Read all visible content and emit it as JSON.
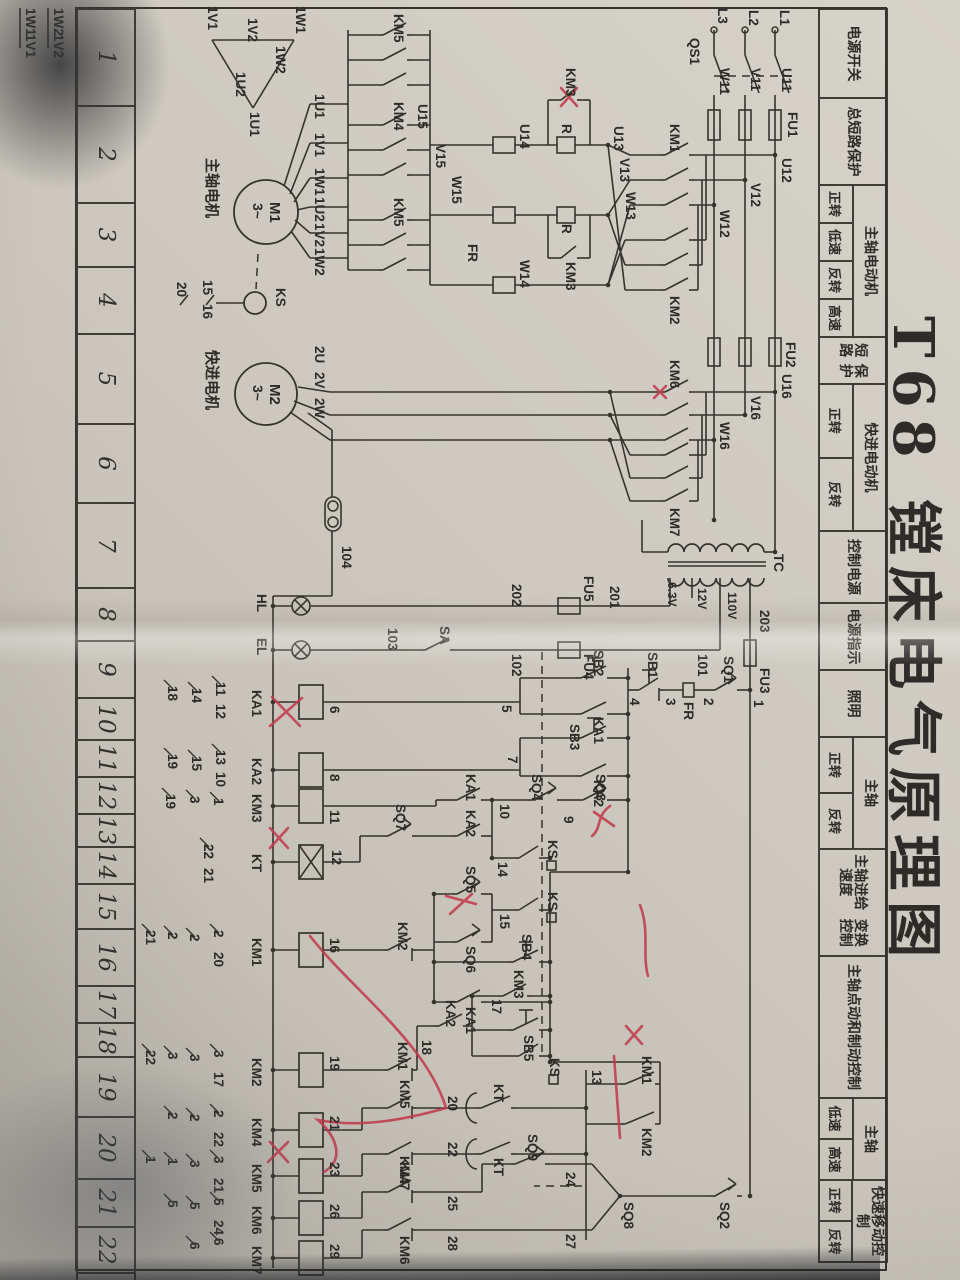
{
  "photo": {
    "paper": "#cdc9c0",
    "ink": "#36332d",
    "red": "#c23b4e"
  },
  "title": {
    "text": "T68 镗床电气原理图"
  },
  "function_table": {
    "cells": [
      {
        "lines": [
          "电源开关"
        ],
        "w": 87
      },
      {
        "lines": [
          "总短路保护"
        ],
        "w": 85
      },
      {
        "lines": [
          "主轴电动机"
        ],
        "w": 150,
        "sub": [
          "正转",
          "低速",
          "反转",
          "高速"
        ]
      },
      {
        "lines": [
          "短路",
          "保护"
        ],
        "w": 45
      },
      {
        "lines": [
          "快进电动机"
        ],
        "w": 145,
        "sub": [
          "正转",
          "反转"
        ]
      },
      {
        "lines": [
          "控制",
          "电源"
        ],
        "w": 70
      },
      {
        "lines": [
          "电源",
          "指示"
        ],
        "w": 65
      },
      {
        "lines": [
          "照明"
        ],
        "w": 65
      },
      {
        "lines": [
          "主轴"
        ],
        "w": 110,
        "sub": [
          "正转",
          "反转"
        ]
      },
      {
        "lines": [
          "主轴进给速度",
          "变换控制"
        ],
        "w": 105
      },
      {
        "lines": [
          "主轴点动",
          "和制动控制"
        ],
        "w": 140
      },
      {
        "lines": [
          "主轴"
        ],
        "w": 80,
        "sub": [
          "低速",
          "高速"
        ]
      },
      {
        "lines": [
          "快速移动控制"
        ],
        "w": 80,
        "sub": [
          "正转",
          "反转"
        ]
      }
    ]
  },
  "column_numbers": {
    "values": [
      "1",
      "2",
      "3",
      "4",
      "5",
      "6",
      "7",
      "8",
      "9",
      "10",
      "11",
      "12",
      "13",
      "14",
      "15",
      "16",
      "17",
      "18",
      "19",
      "20",
      "21",
      "22",
      "23"
    ],
    "widths": [
      95,
      95,
      62,
      65,
      88,
      77,
      83,
      51,
      55,
      40,
      35,
      35,
      31,
      35,
      43,
      55,
      35,
      32,
      58,
      60,
      46,
      44,
      42
    ]
  },
  "schematic": {
    "labels": [
      [
        "L1",
        10,
        180
      ],
      [
        "L2",
        10,
        211
      ],
      [
        "L3",
        8,
        242
      ],
      [
        "QS1",
        38,
        270
      ],
      [
        "U11",
        68,
        178
      ],
      [
        "V11",
        68,
        209
      ],
      [
        "W11",
        68,
        240
      ],
      [
        "FU1",
        112,
        172
      ],
      [
        "U12",
        158,
        178
      ],
      [
        "V12",
        183,
        209
      ],
      [
        "W12",
        210,
        240
      ],
      [
        "KM1",
        124,
        290
      ],
      [
        "KM2",
        296,
        290
      ],
      [
        "U13",
        126,
        346
      ],
      [
        "V13",
        158,
        340
      ],
      [
        "W13",
        192,
        334
      ],
      [
        "R",
        124,
        398
      ],
      [
        "R",
        224,
        398
      ],
      [
        "KM3",
        68,
        394
      ],
      [
        "KM3",
        262,
        394
      ],
      [
        "U14",
        124,
        440
      ],
      [
        "W14",
        260,
        440
      ],
      [
        "FR",
        244,
        492
      ],
      [
        "U15",
        104,
        542
      ],
      [
        "V15",
        144,
        524
      ],
      [
        "W15",
        176,
        508
      ],
      [
        "KM5",
        14,
        566
      ],
      [
        "KM4",
        102,
        566
      ],
      [
        "KM5",
        198,
        566
      ],
      [
        "1U1",
        94,
        645
      ],
      [
        "1V1",
        133,
        645
      ],
      [
        "1W1",
        168,
        645
      ],
      [
        "1U2",
        197,
        645
      ],
      [
        "1V2",
        223,
        645
      ],
      [
        "1W2",
        248,
        645
      ],
      [
        "主轴电机",
        158,
        753,
        15
      ],
      [
        "M1",
        202,
        690,
        15
      ],
      [
        "3~",
        203,
        707,
        14
      ],
      [
        "KS",
        288,
        684
      ],
      [
        "15",
        280,
        757
      ],
      [
        "16",
        304,
        757
      ],
      [
        "20",
        282,
        783
      ],
      [
        "1W1",
        6,
        664
      ],
      [
        "1W2",
        46,
        684
      ],
      [
        "1U1",
        112,
        710
      ],
      [
        "1U2",
        72,
        724
      ],
      [
        "1V2",
        18,
        712
      ],
      [
        "1V1",
        6,
        752
      ],
      [
        "1W2",
        8,
        906
      ],
      [
        "1V2",
        34,
        906
      ],
      [
        "1W1",
        8,
        934
      ],
      [
        "1V1",
        34,
        934
      ],
      [
        "FU2",
        342,
        174
      ],
      [
        "U16",
        374,
        178
      ],
      [
        "V16",
        396,
        209
      ],
      [
        "W16",
        422,
        240
      ],
      [
        "KM6",
        360,
        290
      ],
      [
        "KM7",
        508,
        290
      ],
      [
        "2U",
        346,
        645
      ],
      [
        "2V",
        372,
        645
      ],
      [
        "2W",
        398,
        645
      ],
      [
        "M2",
        384,
        690,
        15
      ],
      [
        "3~",
        385,
        707,
        14
      ],
      [
        "快进电机",
        350,
        753,
        15
      ],
      [
        "104",
        546,
        618
      ],
      [
        "TC",
        554,
        186
      ],
      [
        "110V",
        592,
        232,
        12
      ],
      [
        "12V",
        588,
        262,
        12
      ],
      [
        "6.3V",
        582,
        292,
        12
      ],
      [
        "203",
        610,
        200
      ],
      [
        "FU3",
        668,
        200
      ],
      [
        "1",
        700,
        206
      ],
      [
        "SQ1",
        656,
        236
      ],
      [
        "2",
        698,
        256
      ],
      [
        "FR",
        702,
        276
      ],
      [
        "3",
        698,
        294
      ],
      [
        "SB1",
        652,
        312
      ],
      [
        "4",
        698,
        330
      ],
      [
        "201",
        586,
        350
      ],
      [
        "101",
        654,
        262
      ],
      [
        "FU5",
        576,
        376
      ],
      [
        "FU4",
        654,
        376
      ],
      [
        "202",
        584,
        448
      ],
      [
        "102",
        654,
        448
      ],
      [
        "SA",
        626,
        520
      ],
      [
        "103",
        628,
        572
      ],
      [
        "HL",
        594,
        703
      ],
      [
        "EL",
        638,
        703
      ],
      [
        "SB2",
        650,
        366
      ],
      [
        "KA1",
        717,
        366
      ],
      [
        "5",
        705,
        458
      ],
      [
        "SB3",
        724,
        390
      ],
      [
        "KA2",
        780,
        366
      ],
      [
        "7",
        756,
        452
      ],
      [
        "SQ3",
        774,
        364
      ],
      [
        "9",
        816,
        396
      ],
      [
        "SQ4",
        774,
        428
      ],
      [
        "10",
        804,
        460
      ],
      [
        "KA1",
        774,
        494
      ],
      [
        "KA2",
        810,
        494
      ],
      [
        "SQ7",
        804,
        564
      ],
      [
        "KS",
        840,
        412
      ],
      [
        "14",
        862,
        462
      ],
      [
        "KS",
        892,
        412
      ],
      [
        "15",
        914,
        460
      ],
      [
        "SQ5",
        866,
        494
      ],
      [
        "SQ6",
        946,
        494
      ],
      [
        "SB4",
        934,
        438
      ],
      [
        "KA1",
        1007,
        494
      ],
      [
        "KM2",
        922,
        562
      ],
      [
        "KM3",
        970,
        446
      ],
      [
        "17",
        999,
        468
      ],
      [
        "SB5",
        1035,
        436
      ],
      [
        "KS",
        1058,
        410
      ],
      [
        "KA2",
        1000,
        514
      ],
      [
        "18",
        1040,
        538
      ],
      [
        "KM1",
        1042,
        562
      ],
      [
        "6",
        706,
        630
      ],
      [
        "8",
        774,
        630
      ],
      [
        "11",
        810,
        630
      ],
      [
        "12",
        850,
        628
      ],
      [
        "16",
        938,
        630
      ],
      [
        "19",
        1056,
        630
      ],
      [
        "21",
        1116,
        630
      ],
      [
        "23",
        1162,
        630
      ],
      [
        "26",
        1204,
        630
      ],
      [
        "29",
        1244,
        630
      ],
      [
        "13",
        1070,
        368
      ],
      [
        "KM1",
        1056,
        318
      ],
      [
        "KM2",
        1128,
        318
      ],
      [
        "KT",
        1084,
        466
      ],
      [
        "20",
        1096,
        512
      ],
      [
        "KM5",
        1080,
        560
      ],
      [
        "KT",
        1158,
        466
      ],
      [
        "22",
        1142,
        512
      ],
      [
        "KM4",
        1156,
        560
      ],
      [
        "SQ2",
        1202,
        240
      ],
      [
        "SQ8",
        1202,
        336
      ],
      [
        "24",
        1172,
        394
      ],
      [
        "SQ9",
        1134,
        432
      ],
      [
        "27",
        1234,
        394
      ],
      [
        "25",
        1196,
        512
      ],
      [
        "28",
        1236,
        512
      ],
      [
        "KM7",
        1162,
        560
      ],
      [
        "KM6",
        1236,
        560
      ],
      [
        "KA1",
        690,
        708
      ],
      [
        "KA2",
        758,
        708
      ],
      [
        "KM3",
        794,
        708
      ],
      [
        "KT",
        854,
        708
      ],
      [
        "KM1",
        938,
        708
      ],
      [
        "KM2",
        1058,
        708
      ],
      [
        "KM4",
        1118,
        708
      ],
      [
        "KM5",
        1164,
        708
      ],
      [
        "KM6",
        1206,
        708
      ],
      [
        "KM7",
        1246,
        708
      ],
      [
        "11",
        682,
        744
      ],
      [
        "12",
        704,
        744
      ],
      [
        "14",
        688,
        768
      ],
      [
        "18",
        686,
        792
      ],
      [
        "13",
        750,
        744
      ],
      [
        "10",
        772,
        744
      ],
      [
        "15",
        756,
        768
      ],
      [
        "19",
        754,
        792
      ],
      [
        "1",
        798,
        746
      ],
      [
        "3",
        796,
        770
      ],
      [
        "19",
        794,
        794
      ],
      [
        "22",
        844,
        756
      ],
      [
        "21",
        868,
        756
      ],
      [
        "2",
        930,
        746
      ],
      [
        "20",
        952,
        746
      ],
      [
        "2",
        934,
        770
      ],
      [
        "2",
        932,
        792
      ],
      [
        "21",
        930,
        814
      ],
      [
        "3",
        1050,
        746
      ],
      [
        "17",
        1072,
        746
      ],
      [
        "3",
        1054,
        770
      ],
      [
        "3",
        1052,
        792
      ],
      [
        "22",
        1050,
        814
      ],
      [
        "2",
        1110,
        746
      ],
      [
        "22",
        1132,
        746
      ],
      [
        "2",
        1114,
        770
      ],
      [
        "2",
        1112,
        792
      ],
      [
        "3",
        1156,
        746
      ],
      [
        "21",
        1178,
        746
      ],
      [
        "3",
        1160,
        770
      ],
      [
        "1",
        1158,
        792
      ],
      [
        "1",
        1156,
        814
      ],
      [
        "5",
        1198,
        746
      ],
      [
        "24",
        1220,
        746
      ],
      [
        "5",
        1202,
        770
      ],
      [
        "5",
        1200,
        792
      ],
      [
        "6",
        1238,
        746
      ],
      [
        "6",
        1242,
        770
      ]
    ]
  }
}
